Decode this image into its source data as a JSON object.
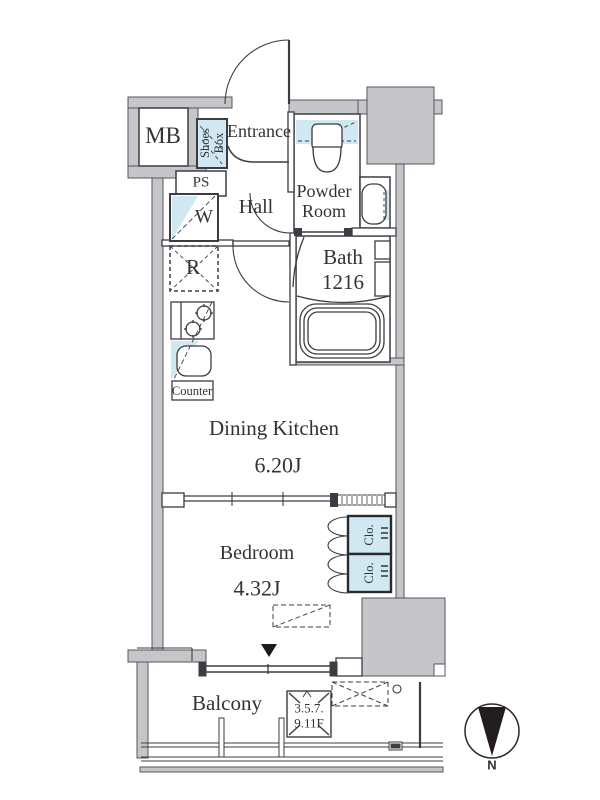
{
  "title": "apartment-floor-plan",
  "rooms": {
    "entrance": "Entrance",
    "hall": "Hall",
    "powder_line1": "Powder",
    "powder_line2": "Room",
    "bath_line1": "Bath",
    "bath_line2": "1216",
    "dining_kitchen": "Dining Kitchen",
    "dining_kitchen_size": "6.20J",
    "bedroom": "Bedroom",
    "bedroom_size": "4.32J",
    "balcony": "Balcony"
  },
  "fixtures": {
    "meter_box": "MB",
    "shoes_line1": "Shoes",
    "shoes_line2": "Box",
    "pipe_space": "PS",
    "washer": "W",
    "refrigerator": "R",
    "counter": "Counter",
    "closet_top": "Clo.",
    "closet_bottom": "Clo."
  },
  "annotations": {
    "floors_line1": "3.5.7.",
    "floors_line2": "9.11F",
    "compass_north": "N"
  },
  "colors": {
    "wall": "#c6c6ca",
    "water_blue": "#cfe8f2",
    "line": "#3c3c42",
    "text": "#333333"
  }
}
